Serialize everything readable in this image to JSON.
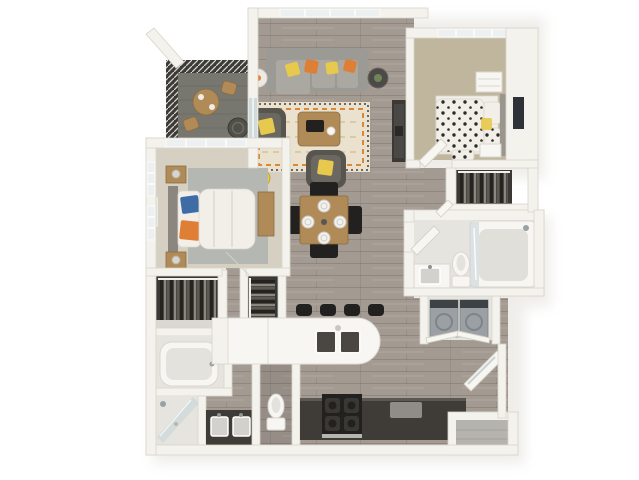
{
  "scene": {
    "type": "3d-apartment-floor-plan-rendering",
    "bedrooms": 2,
    "bathrooms": 2,
    "has_balcony": true,
    "view": "top-down isometric"
  },
  "palette": {
    "bg": "#ffffff",
    "wall": "#f4f2ec",
    "wall_edge": "#d8d4cb",
    "wood_floor": "#a39a92",
    "wood_line": "#8b837b",
    "carpet_b1": "#d5d0c2",
    "carpet_b2": "#c0b69e",
    "balcony_floor": "#77766f",
    "slat_dark": "#3c3b38",
    "sofa_gray": "#9c9a94",
    "cushion": "#aaa8a1",
    "chair_dark": "#57554e",
    "accent_orange": "#df7f35",
    "accent_yellow": "#e7c94d",
    "accent_blue": "#3e6da6",
    "wood_furniture": "#b08a57",
    "rug_cream": "#eae2cf",
    "rug_gray": "#b4b7b2",
    "tile": "#e6e4df",
    "glass_blue": "#c9d6d8",
    "counter_dark": "#3f3c38",
    "appliance_black": "#232120",
    "island_white": "#f7f6f2",
    "fixture_white": "#f7f6f2",
    "clothes_dark": "#4a4741",
    "washer_gray": "#9aa0a4",
    "bed_white": "#f2efe8",
    "polka_dot": "#2b2a27"
  },
  "rooms": [
    {
      "id": "balcony",
      "features": [
        "pergola-slat-rail",
        "bistro-table",
        "bistro-chair",
        "bistro-chair",
        "round-lounge-chair",
        "roof-beam"
      ]
    },
    {
      "id": "living-room",
      "features": [
        "window",
        "sliding-glass-door",
        "sectional-sofa",
        "orange-pillows",
        "yellow-pillows",
        "side-table-left",
        "side-table-right",
        "area-rug",
        "coffee-table",
        "armchair-left",
        "armchair-front",
        "yellow-ottoman",
        "media-console"
      ]
    },
    {
      "id": "dining-area",
      "features": [
        "dining-table",
        "dining-chairs-4",
        "place-settings-4"
      ]
    },
    {
      "id": "kitchen",
      "features": [
        "island-counter",
        "double-sink",
        "bar-stools-4",
        "range",
        "dark-counter",
        "cutting-board"
      ]
    },
    {
      "id": "bedroom-1",
      "features": [
        "corner-windows",
        "bed",
        "blue-pillow",
        "orange-throw",
        "headboard",
        "nightstands-2",
        "lamps",
        "dresser",
        "gray-rug",
        "blue-wall-art"
      ]
    },
    {
      "id": "bedroom-2",
      "features": [
        "window",
        "polka-dot-bed",
        "headboard",
        "pillows",
        "nightstands-2",
        "white-dresser",
        "dark-wall-art"
      ]
    },
    {
      "id": "closet-bedroom-1",
      "features": [
        "hanging-clothes",
        "shelf"
      ]
    },
    {
      "id": "hall-closet",
      "features": [
        "hanging-clothes"
      ]
    },
    {
      "id": "walk-in-closet",
      "features": [
        "hanging-clothes"
      ]
    },
    {
      "id": "bathroom-1",
      "features": [
        "bathtub",
        "corner-shower",
        "glass-panel",
        "double-vanity",
        "toilet-room",
        "toilet",
        "doors"
      ]
    },
    {
      "id": "bathroom-2",
      "features": [
        "walk-in-shower",
        "glass-panel",
        "vanity-sink",
        "toilet",
        "door"
      ]
    },
    {
      "id": "laundry",
      "features": [
        "washer",
        "dryer",
        "bifold-doors"
      ]
    },
    {
      "id": "entry",
      "features": [
        "entry-door",
        "storage-niche"
      ]
    }
  ]
}
